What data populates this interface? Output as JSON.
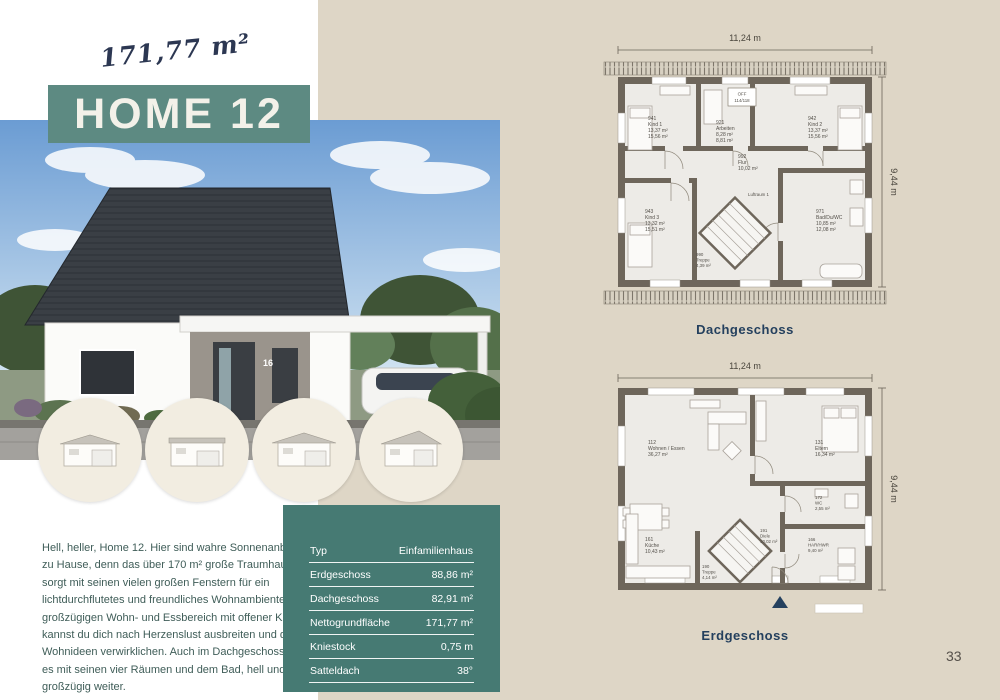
{
  "header": {
    "area_script": "171,77 m²",
    "title": "HOME 12"
  },
  "description": "Hell, heller, Home 12. Hier sind wahre Sonnenanbeter zu Hause, denn das über 170 m² große Traumhaus sorgt mit seinen vielen großen Fenstern für ein lichtdurchflutetes und freundliches Wohnambiente. Im großzügigen Wohn- und Essbereich mit offener Küche, kannst du dich nach Herzenslust ausbreiten und deine Wohnideen verwirklichen. Auch im Dachgeschoss geht es mit seinen vier Räumen und dem Bad, hell und großzügig weiter.",
  "house_photo": {
    "house_number": "16"
  },
  "specs_table": {
    "rows": [
      {
        "label": "Typ",
        "value": "Einfamilienhaus"
      },
      {
        "label": "Erdgeschoss",
        "value": "88,86 m²"
      },
      {
        "label": "Dachgeschoss",
        "value": "82,91 m²"
      },
      {
        "label": "Nettogrundfläche",
        "value": "171,77 m²"
      },
      {
        "label": "Kniestock",
        "value": "0,75 m"
      },
      {
        "label": "Satteldach",
        "value": "38°"
      }
    ]
  },
  "floor_plans": {
    "width_dim": "11,24 m",
    "height_dim": "9,44 m",
    "dachgeschoss": {
      "label": "Dachgeschoss",
      "skylight_line1": "OFF",
      "skylight_line2": "114/118",
      "rooms": {
        "kind1": {
          "id": "941",
          "name": "Kind 1",
          "area1": "13,37 m²",
          "area2": "15,56 m²"
        },
        "arbeiten": {
          "id": "921",
          "name": "Arbeiten",
          "area1": "8,28 m²",
          "area2": "8,81 m²"
        },
        "kind2": {
          "id": "942",
          "name": "Kind 2",
          "area1": "13,37 m²",
          "area2": "15,56 m²"
        },
        "kind3": {
          "id": "943",
          "name": "Kind 3",
          "area1": "13,32 m²",
          "area2": "15,51 m²"
        },
        "flur": {
          "id": "992",
          "name": "Flur",
          "area1": "10,02 m²"
        },
        "bad": {
          "id": "971",
          "name": "Bad/Du/WC",
          "area1": "10,85 m²",
          "area2": "12,08 m²"
        },
        "treppe": {
          "id": "990",
          "name": "Treppe",
          "area1": "4,39 m²"
        },
        "luftraum": {
          "name": "Luftraum 1"
        }
      }
    },
    "erdgeschoss": {
      "label": "Erdgeschoss",
      "rooms": {
        "wohnen": {
          "id": "112",
          "name": "Wohnen / Essen",
          "area1": "36,27 m²"
        },
        "eltern": {
          "id": "131",
          "name": "Eltern",
          "area1": "16,34 m²"
        },
        "kueche": {
          "id": "161",
          "name": "Küche",
          "area1": "10,43 m²"
        },
        "diele": {
          "id": "191",
          "name": "Diele",
          "area1": "10,02 m²"
        },
        "treppe": {
          "id": "190",
          "name": "Treppe",
          "area1": "4,14 m²"
        },
        "wc": {
          "id": "172",
          "name": "WC",
          "area1": "2,55 m²"
        },
        "hwr": {
          "id": "166",
          "name": "HAR/HWR",
          "area1": "9,40 m²"
        }
      }
    }
  },
  "page_number": "33"
}
